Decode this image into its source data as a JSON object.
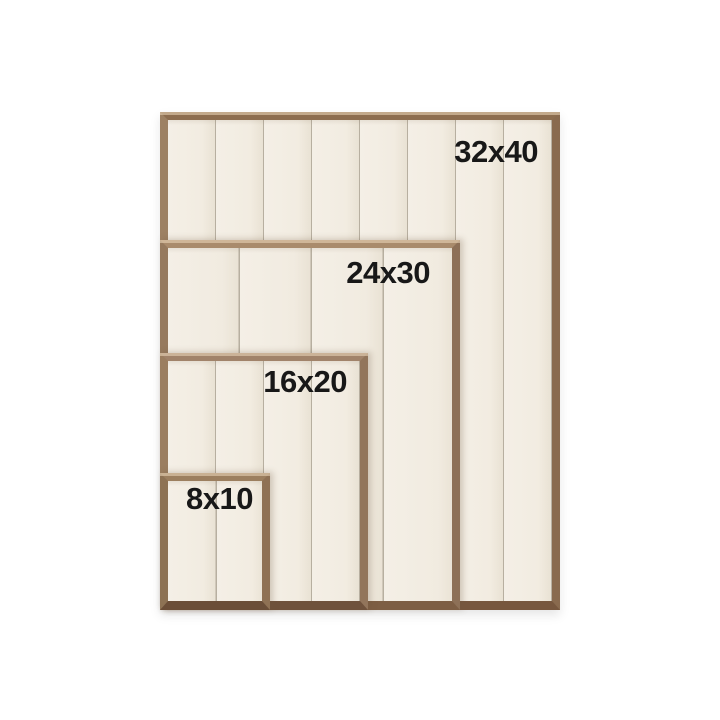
{
  "frames": [
    {
      "id": "32x40",
      "label": "32x40"
    },
    {
      "id": "24x30",
      "label": "24x30"
    },
    {
      "id": "16x20",
      "label": "16x20"
    },
    {
      "id": "8x10",
      "label": "8x10"
    }
  ],
  "palette": {
    "background": "#ffffff",
    "panel_cream": "#f2ece1",
    "plank_seam": "#b7afa0",
    "wood_light": "#a08264",
    "wood_mid": "#8c6d50",
    "wood_dark": "#74553c",
    "label_text": "#181818"
  }
}
